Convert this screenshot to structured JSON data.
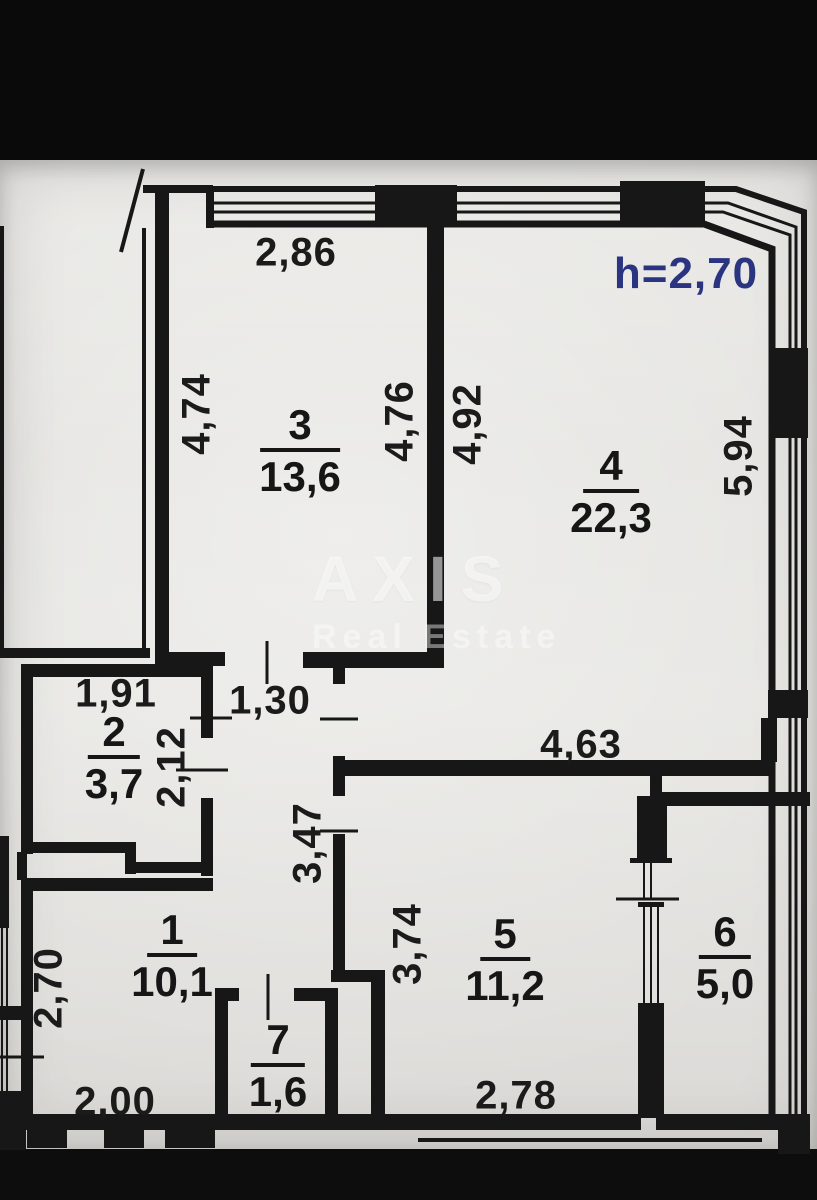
{
  "scan": {
    "description": "photographed apartment floor plan (BTI style)",
    "paper_color": "#e4e3e0",
    "ink_color": "#171717",
    "accent_color": "#2a3480",
    "height_note": "h=2,70",
    "watermark": {
      "brand": "AXIS",
      "subtitle": "Real Estate"
    }
  },
  "rooms": {
    "r1": {
      "number": "1",
      "area": "10,1"
    },
    "r2": {
      "number": "2",
      "area": "3,7"
    },
    "r3": {
      "number": "3",
      "area": "13,6"
    },
    "r4": {
      "number": "4",
      "area": "22,3"
    },
    "r5": {
      "number": "5",
      "area": "11,2"
    },
    "r6": {
      "number": "6",
      "area": "5,0"
    },
    "r7": {
      "number": "7",
      "area": "1,6"
    }
  },
  "dimensions": {
    "room3_top_width": "2,86",
    "room3_left_height": "4,74",
    "room3_right_height": "4,76",
    "room4_left_height": "4,92",
    "room4_right_height": "5,94",
    "room4_bottom_width": "4,63",
    "room2_top_width": "1,91",
    "room2_right_height": "2,12",
    "corridor_width": "1,30",
    "corridor_height": "3,47",
    "hall_height": "3,74",
    "room1_left_height": "2,70",
    "room1_bottom_width": "2,00",
    "room5_bottom_width": "2,78"
  }
}
